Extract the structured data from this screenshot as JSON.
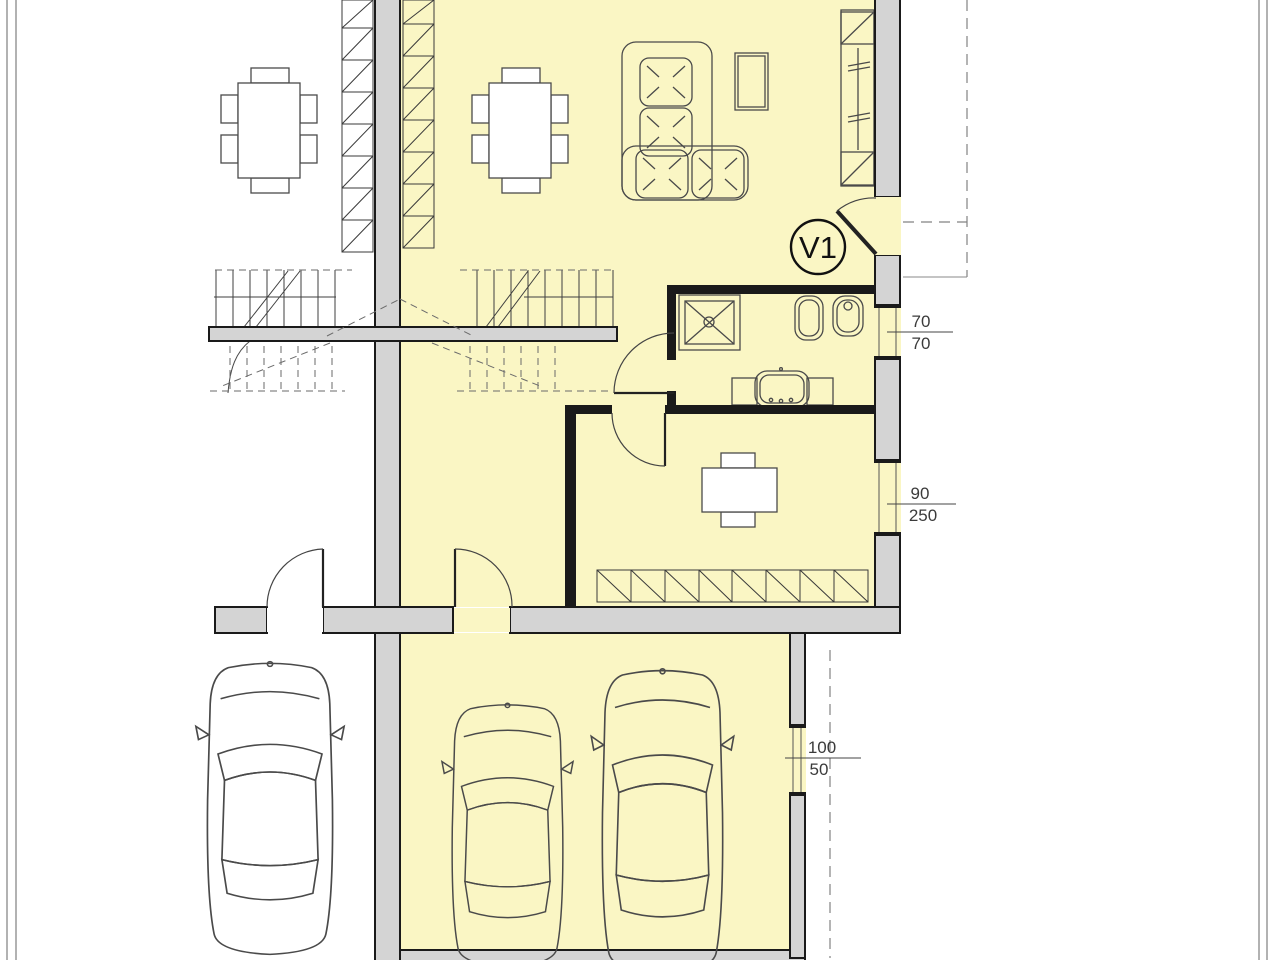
{
  "drawing": {
    "type": "architectural-floor-plan",
    "entrance_label": "V1",
    "dims": {
      "bath_window": {
        "width": "70",
        "height": "70"
      },
      "bedroom_window": {
        "width": "90",
        "height": "250"
      },
      "garage_window": {
        "width": "100",
        "height": "50"
      }
    },
    "colors": {
      "room_fill": "#faf6c4",
      "wall_fill": "#d4d4d4",
      "line": "#1a1a1a",
      "dim_text": "#3b3b3b"
    },
    "legend": {
      "highlighted_unit": "right duplex unit with garage",
      "rooms": [
        "living-dining room",
        "hallway-stairs",
        "bathroom",
        "bedroom",
        "garage"
      ]
    }
  }
}
